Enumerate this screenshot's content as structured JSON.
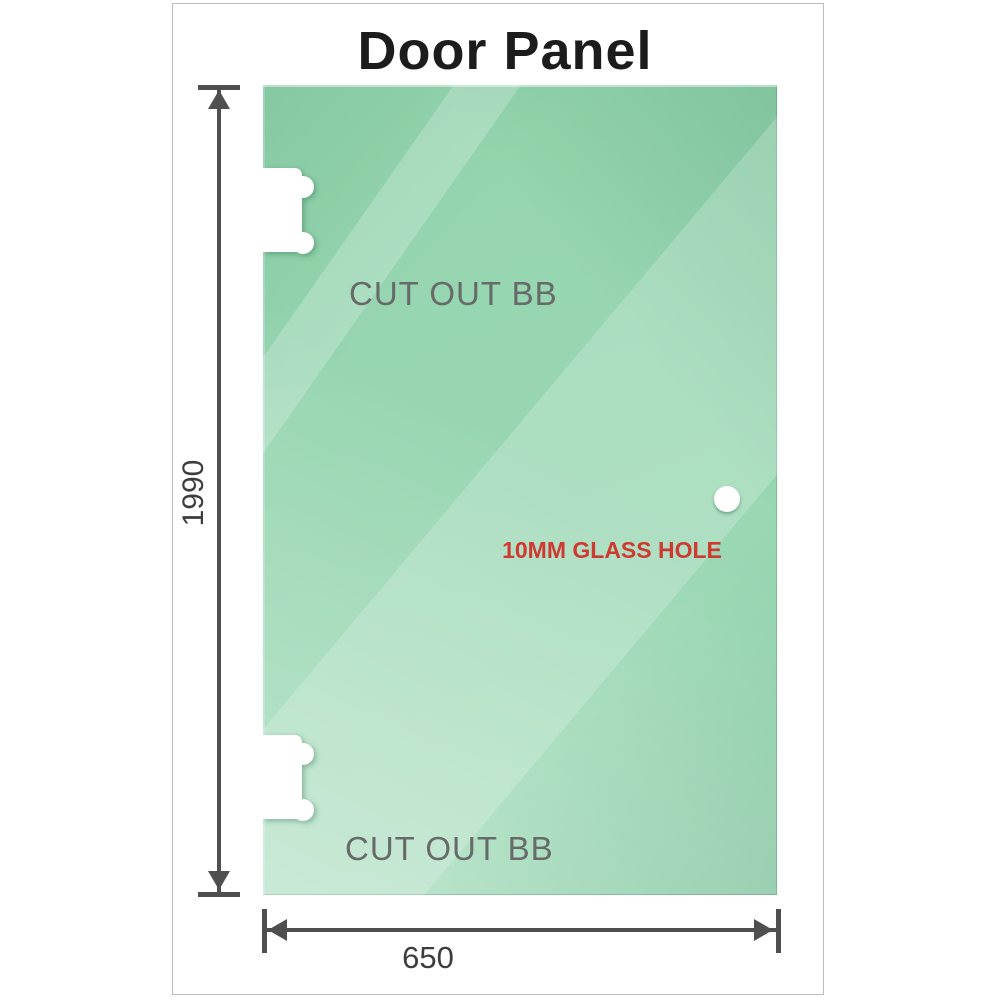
{
  "title": "Door Panel",
  "panel": {
    "cutouts": [
      {
        "label": "CUT OUT BB"
      },
      {
        "label": "CUT OUT BB"
      }
    ],
    "hole": {
      "label": "10MM GLASS HOLE"
    }
  },
  "dimensions": {
    "height": {
      "label": "1990"
    },
    "width": {
      "label": "650"
    }
  },
  "colors": {
    "glass_mid": "#93d4ad",
    "glass_mid2": "#9ed9b6",
    "dimension_line": "#4f4f4f",
    "dim_text": "#3d3d3d",
    "cutout_text": "#666b69",
    "hole_text": "#cf3a30",
    "frame_border": "#bcbcbc",
    "title_text": "#1c1c1c"
  }
}
